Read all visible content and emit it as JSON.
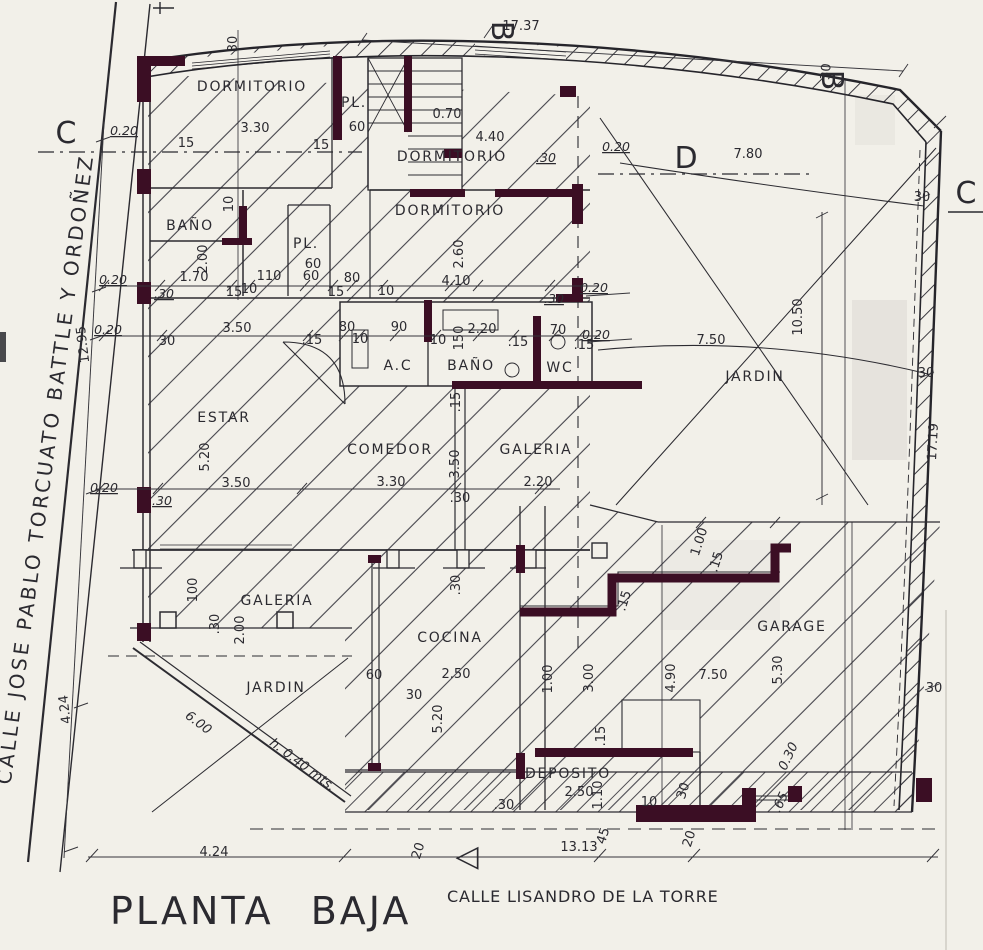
{
  "title": "PLANTA BAJA",
  "streets": {
    "left": "CALLE JOSE PABLO TORCUATO BATTLE Y ORDOÑEZ",
    "bottom": "CALLE LISANDRO DE LA TORRE"
  },
  "colors": {
    "paper": "#f2f0e9",
    "ink": "#2b2a30",
    "wall": "#3b0e24"
  },
  "drawing": {
    "rooms": [
      {
        "name": "DORMITORIO",
        "x": 252,
        "y": 91
      },
      {
        "name": "DORMITORIO",
        "x": 452,
        "y": 161
      },
      {
        "name": "DORMITORIO",
        "x": 450,
        "y": 215
      },
      {
        "name": "BAÑO",
        "x": 190,
        "y": 230
      },
      {
        "name": "PL.",
        "x": 354,
        "y": 107
      },
      {
        "name": "PL.",
        "x": 306,
        "y": 248
      },
      {
        "name": "A.C",
        "x": 398,
        "y": 370
      },
      {
        "name": "BAÑO",
        "x": 471,
        "y": 370
      },
      {
        "name": "WC",
        "x": 560,
        "y": 372
      },
      {
        "name": "ESTAR",
        "x": 224,
        "y": 422
      },
      {
        "name": "COMEDOR",
        "x": 390,
        "y": 454
      },
      {
        "name": "GALERIA",
        "x": 536,
        "y": 454
      },
      {
        "name": "JARDIN",
        "x": 755,
        "y": 381
      },
      {
        "name": "GALERIA",
        "x": 277,
        "y": 605
      },
      {
        "name": "JARDIN",
        "x": 276,
        "y": 692
      },
      {
        "name": "COCINA",
        "x": 450,
        "y": 642
      },
      {
        "name": "GARAGE",
        "x": 792,
        "y": 631
      },
      {
        "name": "DEPOSITO",
        "x": 568,
        "y": 778
      }
    ],
    "section_marks": [
      {
        "label": "C",
        "x": 66,
        "y": 143
      },
      {
        "label": "D",
        "x": 686,
        "y": 168
      },
      {
        "label": "B",
        "x": 492,
        "y": 31,
        "rot": 90,
        "size": 17
      },
      {
        "label": "B",
        "x": 822,
        "y": 80,
        "rot": 90,
        "size": 15
      },
      {
        "label": "A",
        "glyph": "◁",
        "x": 467,
        "y": 866,
        "size": 30
      },
      {
        "label": "C",
        "x": 966,
        "y": 203,
        "size": 28
      }
    ],
    "dimensions": [
      {
        "text": "17.37",
        "x": 521,
        "y": 30
      },
      {
        "text": "30",
        "x": 237,
        "y": 44,
        "rot": -90
      },
      {
        "text": "0.70",
        "x": 447,
        "y": 118
      },
      {
        "text": "4.40",
        "x": 490,
        "y": 141
      },
      {
        "text": "0.20",
        "x": 124,
        "y": 135,
        "u": 1
      },
      {
        "text": "3.30",
        "x": 255,
        "y": 132
      },
      {
        "text": "15",
        "x": 186,
        "y": 147
      },
      {
        "text": "15",
        "x": 321,
        "y": 149
      },
      {
        "text": "60",
        "x": 357,
        "y": 131
      },
      {
        "text": ".30",
        "x": 546,
        "y": 162,
        "u": 1
      },
      {
        "text": "0.20",
        "x": 616,
        "y": 151,
        "u": 1
      },
      {
        "text": "7.80",
        "x": 748,
        "y": 158
      },
      {
        "text": "30",
        "x": 830,
        "y": 72,
        "rot": -85
      },
      {
        "text": "30",
        "x": 922,
        "y": 201
      },
      {
        "text": "10",
        "x": 233,
        "y": 204,
        "rot": -90
      },
      {
        "text": "2.00",
        "x": 207,
        "y": 259,
        "rot": -90
      },
      {
        "text": "2.60",
        "x": 463,
        "y": 254,
        "rot": -90
      },
      {
        "text": "60",
        "x": 313,
        "y": 268
      },
      {
        "text": "1.70",
        "x": 194,
        "y": 281
      },
      {
        "text": "110",
        "x": 269,
        "y": 280
      },
      {
        "text": "60",
        "x": 311,
        "y": 280
      },
      {
        "text": "80",
        "x": 352,
        "y": 282
      },
      {
        "text": "4.10",
        "x": 456,
        "y": 285
      },
      {
        "text": "0.20",
        "x": 113,
        "y": 284,
        "u": 1
      },
      {
        "text": ".30",
        "x": 164,
        "y": 298,
        "u": 1
      },
      {
        "text": "15",
        "x": 234,
        "y": 296
      },
      {
        "text": "10",
        "x": 249,
        "y": 293
      },
      {
        "text": "15",
        "x": 336,
        "y": 296
      },
      {
        "text": "10",
        "x": 386,
        "y": 295
      },
      {
        "text": ".30",
        "x": 554,
        "y": 303,
        "u": 1
      },
      {
        "text": "0.20",
        "x": 594,
        "y": 292,
        "u": 1
      },
      {
        "text": "0.20",
        "x": 108,
        "y": 334,
        "u": 1
      },
      {
        "text": "30",
        "x": 167,
        "y": 345
      },
      {
        "text": "3.50",
        "x": 237,
        "y": 332
      },
      {
        "text": ".15",
        "x": 312,
        "y": 344
      },
      {
        "text": "80",
        "x": 347,
        "y": 331
      },
      {
        "text": "10",
        "x": 360,
        "y": 343
      },
      {
        "text": "90",
        "x": 399,
        "y": 331
      },
      {
        "text": "10",
        "x": 438,
        "y": 344
      },
      {
        "text": "150",
        "x": 463,
        "y": 338,
        "rot": -90
      },
      {
        "text": "2.20",
        "x": 482,
        "y": 333
      },
      {
        "text": ".15",
        "x": 518,
        "y": 346
      },
      {
        "text": "70",
        "x": 558,
        "y": 334
      },
      {
        "text": ".15",
        "x": 584,
        "y": 349
      },
      {
        "text": "0.20",
        "x": 596,
        "y": 339,
        "u": 1
      },
      {
        "text": "7.50",
        "x": 711,
        "y": 344
      },
      {
        "text": "10.50",
        "x": 802,
        "y": 317,
        "rot": -90
      },
      {
        "text": "12.95",
        "x": 87,
        "y": 344,
        "rot": -97
      },
      {
        "text": ".15",
        "x": 460,
        "y": 402,
        "rot": -90
      },
      {
        "text": "5.20",
        "x": 209,
        "y": 457,
        "rot": -90
      },
      {
        "text": "3.50",
        "x": 459,
        "y": 464,
        "rot": -90
      },
      {
        "text": "17.19",
        "x": 937,
        "y": 442,
        "rot": -87
      },
      {
        "text": "30",
        "x": 926,
        "y": 377
      },
      {
        "text": "0.20",
        "x": 104,
        "y": 492,
        "u": 1
      },
      {
        "text": ".30",
        "x": 162,
        "y": 505,
        "u": 1
      },
      {
        "text": "3.50",
        "x": 236,
        "y": 487
      },
      {
        "text": "3.30",
        "x": 391,
        "y": 486
      },
      {
        "text": ".30",
        "x": 460,
        "y": 502
      },
      {
        "text": "2.20",
        "x": 538,
        "y": 486
      },
      {
        "text": "30",
        "x": 934,
        "y": 692
      },
      {
        "text": "100",
        "x": 197,
        "y": 590,
        "rot": -90
      },
      {
        "text": ".30",
        "x": 219,
        "y": 624,
        "rot": -90
      },
      {
        "text": "2.00",
        "x": 244,
        "y": 630,
        "rot": -90
      },
      {
        "text": "4.24",
        "x": 69,
        "y": 709,
        "rot": -97
      },
      {
        "text": "60",
        "x": 374,
        "y": 679
      },
      {
        "text": "2.50",
        "x": 456,
        "y": 678
      },
      {
        "text": "30",
        "x": 414,
        "y": 699
      },
      {
        "text": ".30",
        "x": 460,
        "y": 585,
        "rot": -90
      },
      {
        "text": "5.20",
        "x": 442,
        "y": 719,
        "rot": -90
      },
      {
        "text": "1.00",
        "x": 552,
        "y": 679,
        "rot": -90
      },
      {
        "text": "3.00",
        "x": 593,
        "y": 678,
        "rot": -90
      },
      {
        "text": "4.90",
        "x": 675,
        "y": 678,
        "rot": -90
      },
      {
        "text": "7.50",
        "x": 713,
        "y": 679
      },
      {
        "text": "5.30",
        "x": 782,
        "y": 670,
        "rot": -90
      },
      {
        "text": "1.00",
        "x": 703,
        "y": 543,
        "rot": -72
      },
      {
        "text": ".15",
        "x": 720,
        "y": 563,
        "rot": -72
      },
      {
        "text": ".15",
        "x": 628,
        "y": 602,
        "rot": -72
      },
      {
        "text": "0.30",
        "x": 792,
        "y": 758,
        "rot": -65,
        "it": 1
      },
      {
        "text": ".65",
        "x": 784,
        "y": 804,
        "rot": -65,
        "it": 1
      },
      {
        "text": "6.00",
        "x": 196,
        "y": 726,
        "rot": 37,
        "it": 1
      },
      {
        "text": "h. 0.40 mts.",
        "x": 300,
        "y": 768,
        "rot": 37,
        "it": 1
      },
      {
        "text": ".15",
        "x": 605,
        "y": 736,
        "rot": -90
      },
      {
        "text": "2.50",
        "x": 579,
        "y": 796
      },
      {
        "text": "1.10",
        "x": 602,
        "y": 795,
        "rot": -90
      },
      {
        "text": "10",
        "x": 649,
        "y": 806
      },
      {
        "text": "30",
        "x": 687,
        "y": 792,
        "rot": -72
      },
      {
        "text": ".30",
        "x": 504,
        "y": 809
      },
      {
        "text": "13.13",
        "x": 579,
        "y": 851
      },
      {
        "text": "4.24",
        "x": 214,
        "y": 856
      },
      {
        "text": "20",
        "x": 422,
        "y": 852,
        "rot": -72
      },
      {
        "text": "45",
        "x": 607,
        "y": 837,
        "rot": -72
      },
      {
        "text": "20",
        "x": 693,
        "y": 840,
        "rot": -72
      }
    ]
  }
}
